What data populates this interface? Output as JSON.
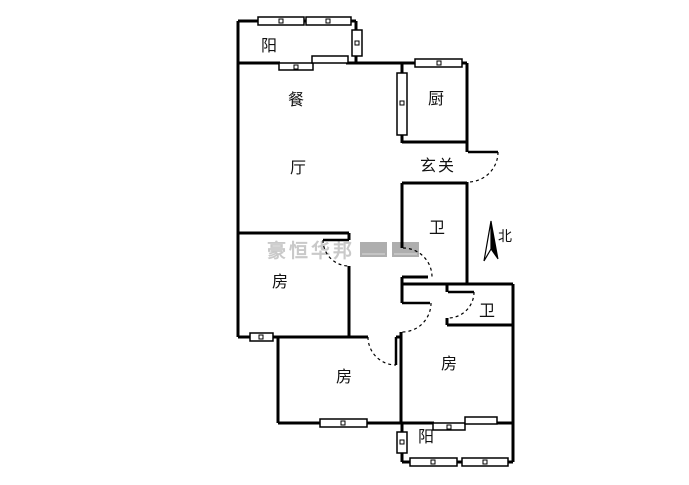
{
  "labels": {
    "balcony_top": "阳",
    "dining": "餐",
    "kitchen": "厨",
    "living": "厅",
    "entry": "玄关",
    "bath_1": "卫",
    "north": "北",
    "room_mid": "房",
    "bath_2": "卫",
    "room_bottom_left": "房",
    "room_bottom_right": "房",
    "balcony_bottom": "阳"
  },
  "watermark": {
    "text": "豪恒华邦"
  },
  "colors": {
    "wall": "#000000",
    "background": "#ffffff",
    "watermark": "#c9c9c9"
  }
}
